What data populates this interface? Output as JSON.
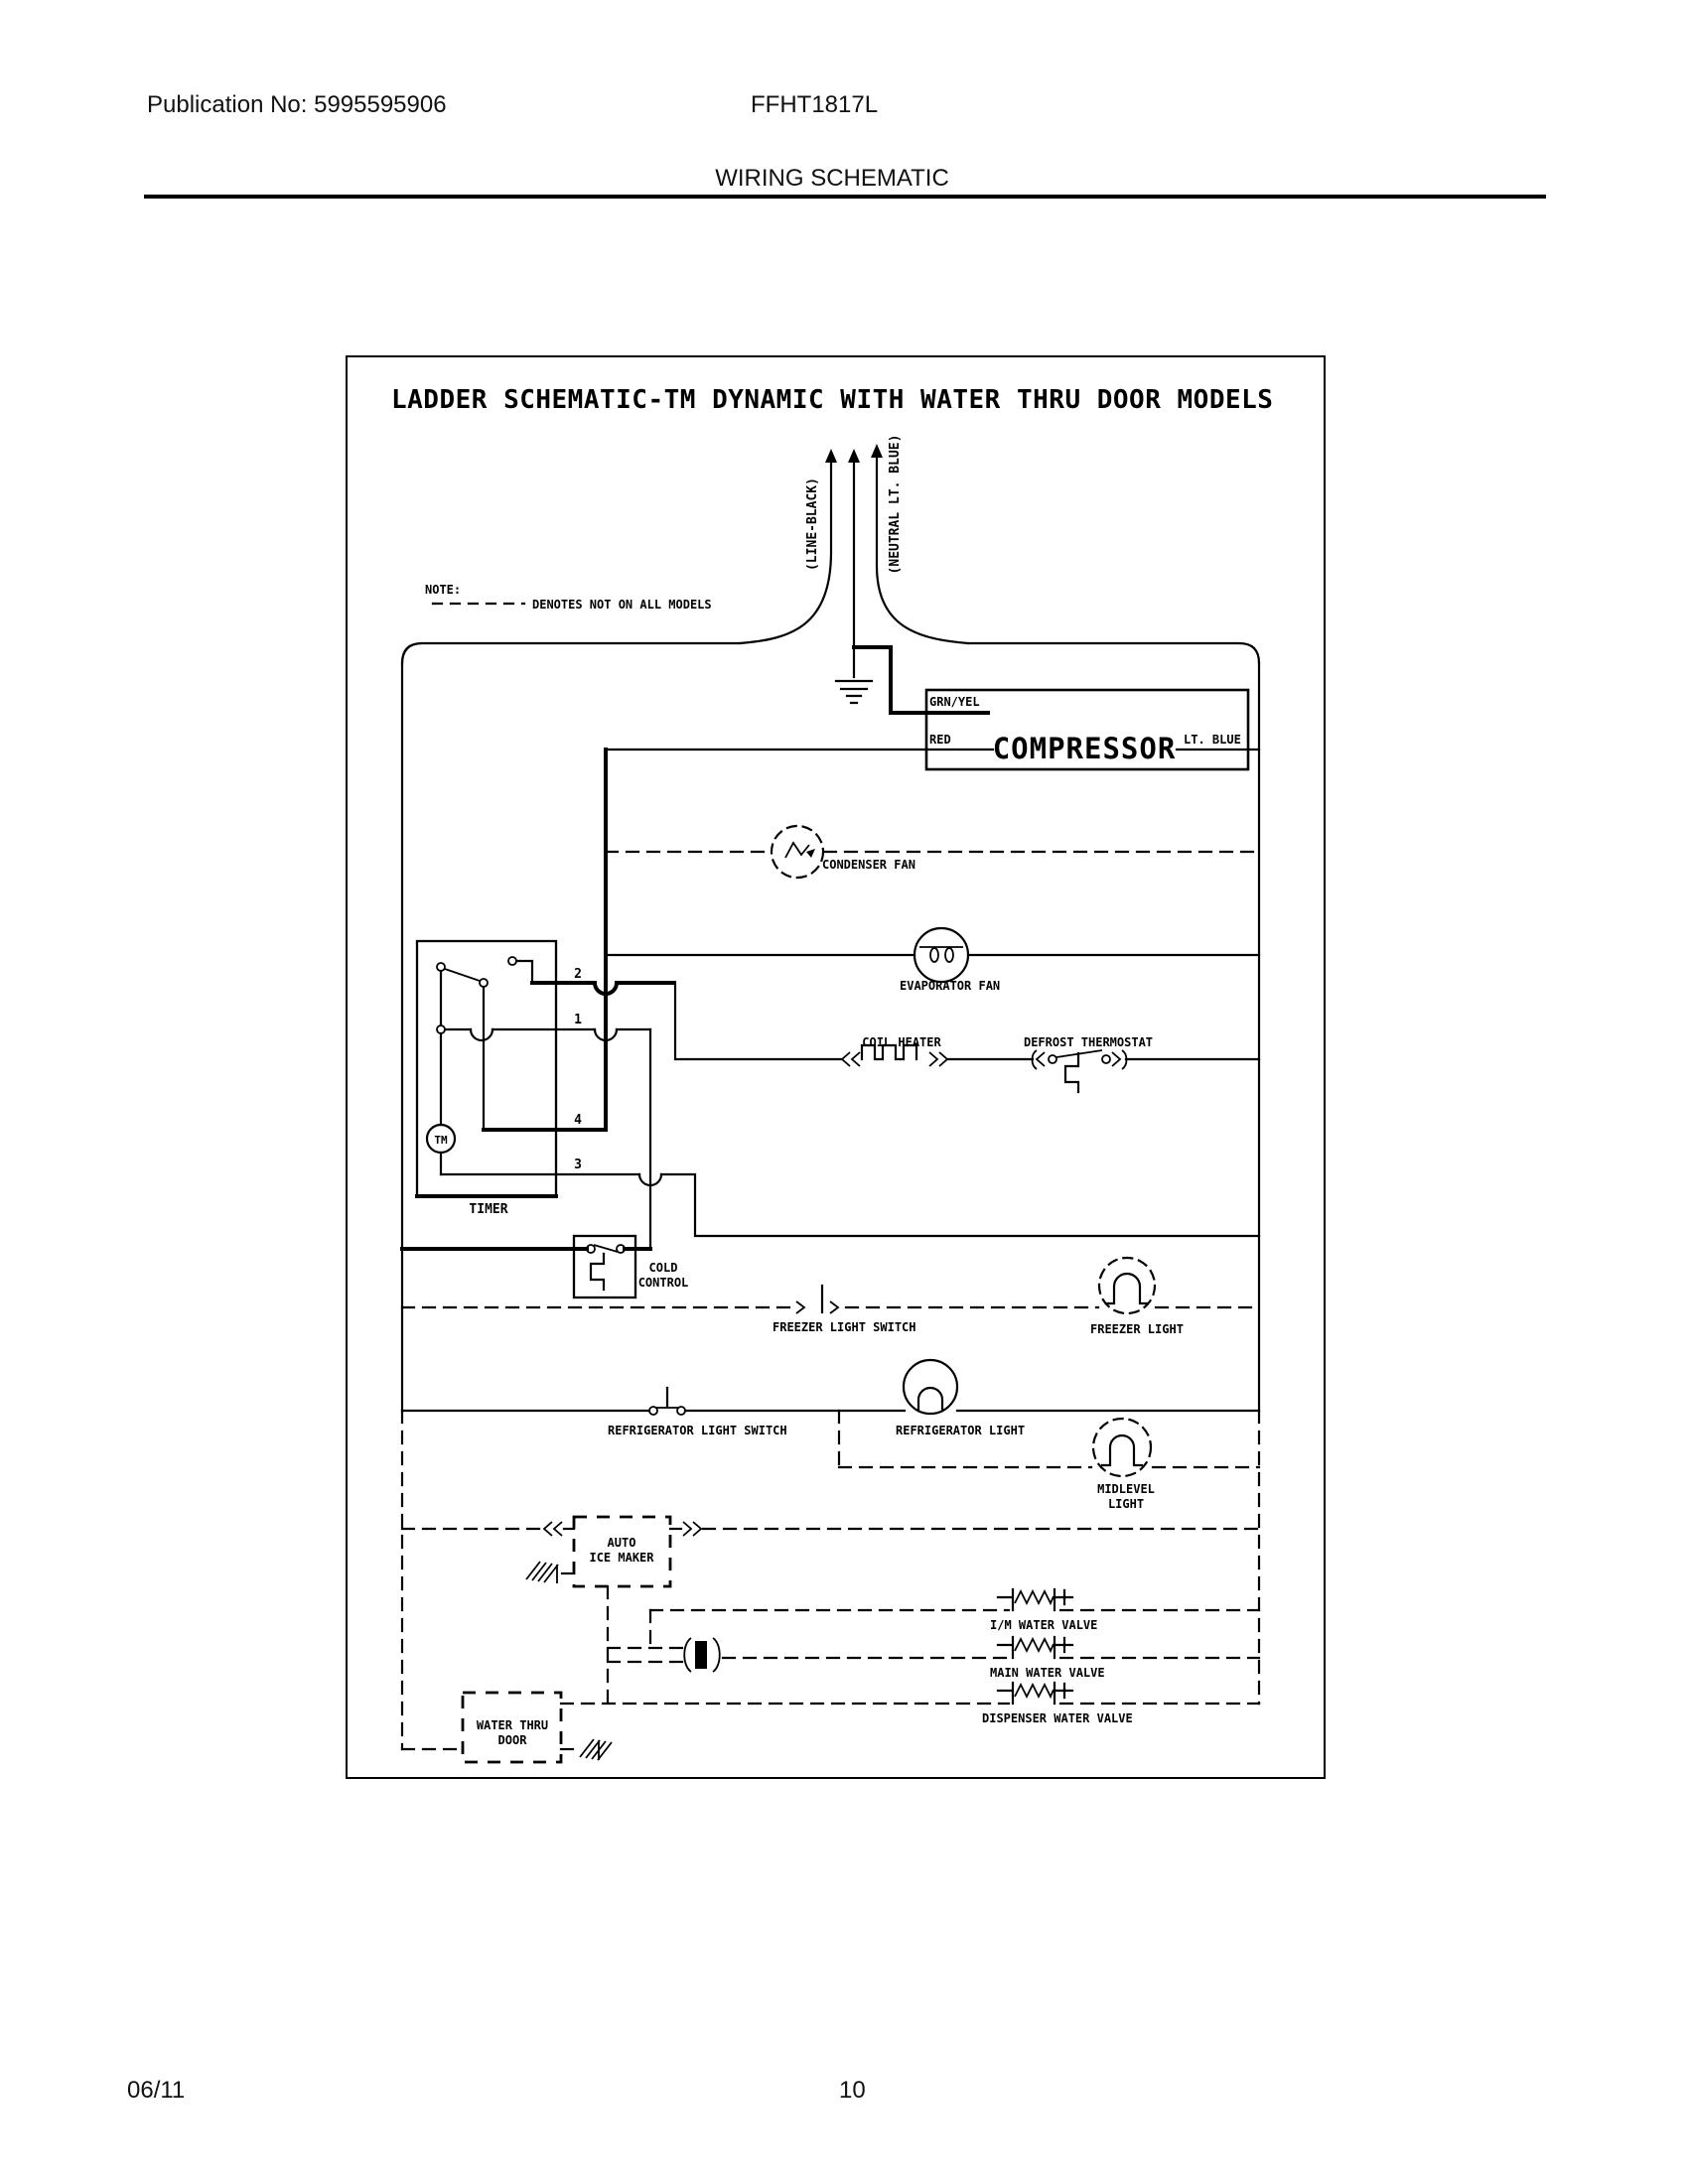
{
  "header": {
    "publication": "Publication No: 5995595906",
    "model": "FFHT1817L",
    "section_title": "WIRING SCHEMATIC"
  },
  "diagram": {
    "title": "LADDER SCHEMATIC-TM DYNAMIC WITH WATER THRU DOOR MODELS",
    "note_label": "NOTE:",
    "note_text": "DENOTES NOT ON ALL MODELS",
    "supply_line": "(LINE-BLACK)",
    "supply_neutral": "(NEUTRAL LT. BLUE)",
    "compressor": {
      "ground_wire": "GRN/YEL",
      "run_wire": "RED",
      "name": "COMPRESSOR",
      "neutral_wire": "LT. BLUE"
    },
    "condenser_fan": "CONDENSER FAN",
    "evaporator_fan": "EVAPORATOR FAN",
    "coil_heater": "COIL HEATER",
    "defrost_thermostat": "DEFROST THERMOSTAT",
    "timer": {
      "name": "TIMER",
      "motor": "TM",
      "t1": "1",
      "t2": "2",
      "t3": "3",
      "t4": "4"
    },
    "cold_control": {
      "line1": "COLD",
      "line2": "CONTROL"
    },
    "freezer_light_switch": "FREEZER LIGHT SWITCH",
    "freezer_light": "FREEZER LIGHT",
    "refrigerator_light_switch": "REFRIGERATOR LIGHT SWITCH",
    "refrigerator_light": "REFRIGERATOR LIGHT",
    "midlevel_light": {
      "line1": "MIDLEVEL",
      "line2": "LIGHT"
    },
    "ice_maker": {
      "line1": "AUTO",
      "line2": "ICE MAKER"
    },
    "im_water_valve": "I/M WATER VALVE",
    "main_water_valve": "MAIN WATER VALVE",
    "dispenser_water_valve": "DISPENSER WATER VALVE",
    "water_thru_door": {
      "line1": "WATER THRU",
      "line2": "DOOR"
    }
  },
  "footer": {
    "date": "06/11",
    "page": "10"
  },
  "colors": {
    "ink": "#000000",
    "paper": "#ffffff"
  }
}
